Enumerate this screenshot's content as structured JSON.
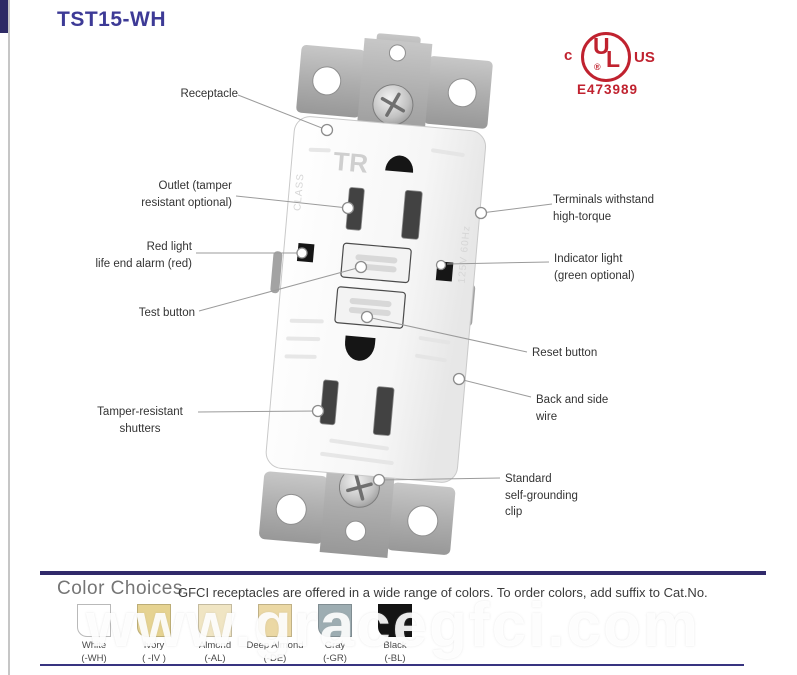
{
  "page": {
    "title": "TST15-WH"
  },
  "certification": {
    "c": "c",
    "u": "U",
    "l": "L",
    "registered": "®",
    "us": "US",
    "file_number": "E473989",
    "color": "#c0222f"
  },
  "device": {
    "markings": {
      "tr": "TR",
      "class": "CLASS",
      "rating": "125V 60Hz"
    }
  },
  "callouts": {
    "left": [
      {
        "label": "Receptacle"
      },
      {
        "label": "Outlet (tamper\nresistant optional)"
      },
      {
        "label": "Red light\nlife end alarm (red)"
      },
      {
        "label": "Test button"
      },
      {
        "label": "Tamper-resistant\nshutters"
      }
    ],
    "right": [
      {
        "label": "Terminals withstand\nhigh-torque"
      },
      {
        "label": "Indicator light\n(green optional)"
      },
      {
        "label": "Reset button"
      },
      {
        "label": "Back and side\nwire"
      },
      {
        "label": "Standard\nself-grounding\nclip"
      }
    ]
  },
  "color_choices": {
    "heading": "Color Choices",
    "description": "GFCI receptacles are offered in a wide range of colors. To order colors, add suffix to Cat.No.",
    "swatches": [
      {
        "name": "White",
        "suffix": "(-WH)",
        "hex": "#ffffff"
      },
      {
        "name": "Ivory",
        "suffix": "( -IV )",
        "hex": "#e6d391"
      },
      {
        "name": "Almond",
        "suffix": "(-AL)",
        "hex": "#f0e5c3"
      },
      {
        "name": "Deep Almond",
        "suffix": "(-DE)",
        "hex": "#ebd8a4"
      },
      {
        "name": "Gray",
        "suffix": "(-GR)",
        "hex": "#9dadb2"
      },
      {
        "name": "Black",
        "suffix": "(-BL)",
        "hex": "#141414"
      }
    ]
  },
  "watermark": "www.gracegfci.com"
}
